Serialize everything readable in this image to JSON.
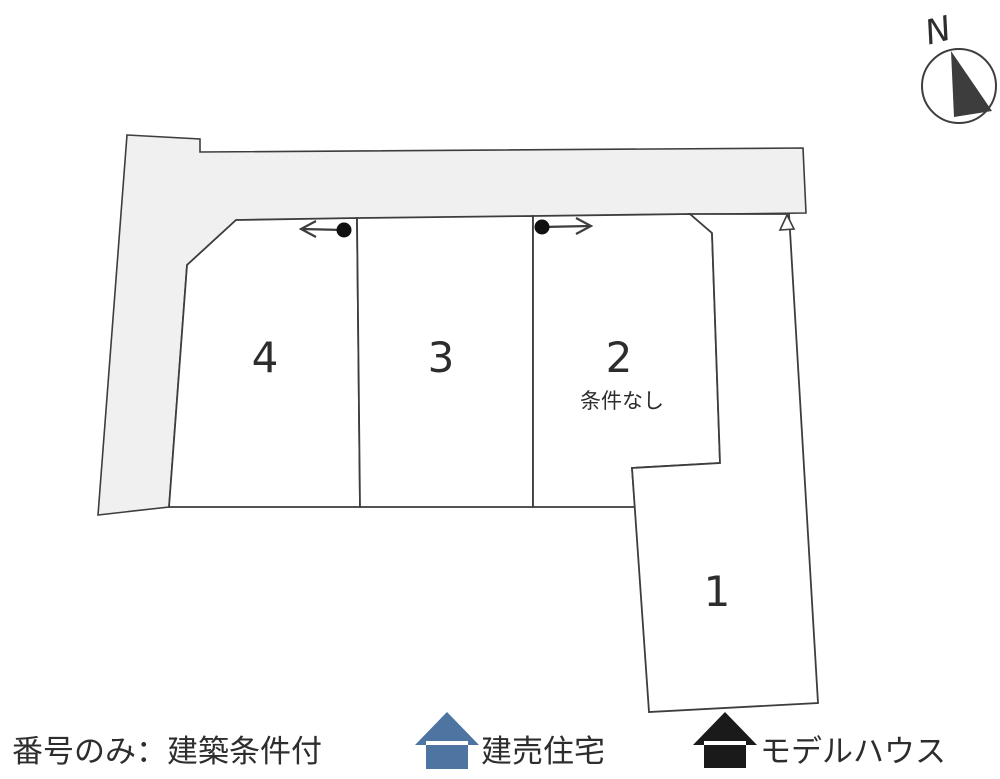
{
  "compass": {
    "north_label": "N"
  },
  "lots": {
    "lot1": {
      "number": "1"
    },
    "lot2": {
      "number": "2",
      "note": "条件なし"
    },
    "lot3": {
      "number": "3"
    },
    "lot4": {
      "number": "4"
    }
  },
  "legend": {
    "note": "番号のみ：建築条件付",
    "items": [
      {
        "icon": "house-icon-blue",
        "label": "建売住宅",
        "color": "#4e74a2"
      },
      {
        "icon": "house-icon-black",
        "label": "モデルハウス",
        "color": "#1a1a1a"
      }
    ]
  },
  "colors": {
    "road_fill": "#f0f0f0",
    "lot_fill": "#ffffff",
    "line": "#3d3d3d",
    "text": "#2d2d2d",
    "marker": "#111111",
    "background": "#ffffff"
  }
}
